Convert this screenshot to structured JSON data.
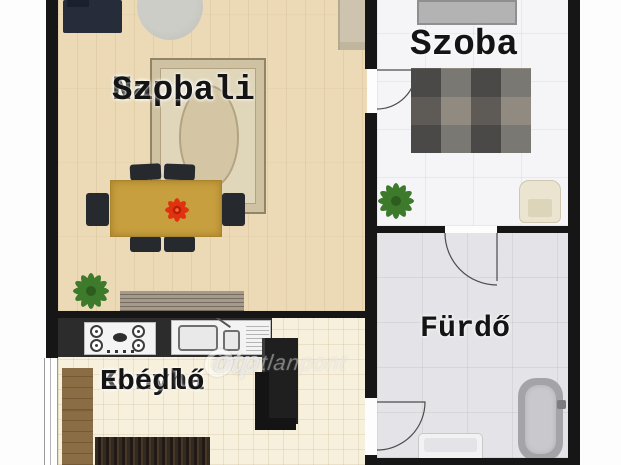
{
  "floorplan": {
    "rooms": {
      "living": {
        "label_line1": "Nappali",
        "label_line2": "Szoba"
      },
      "bedroom": {
        "label": "Szoba"
      },
      "bathroom": {
        "label": "Fürdő"
      },
      "kitchen": {
        "label_line1": "Konyha",
        "label_line2": "Ebédlő"
      }
    },
    "watermark": {
      "brand": "otp",
      "suffix": "ingatlanpont"
    },
    "colors": {
      "wall": "#161616",
      "wood_floor": "#ecdab6",
      "bedroom_tile": "#f5f5f8",
      "bathroom_tile": "#e4e4e8",
      "kitchen_tile": "#f7f0dd",
      "table": "#c79f3e",
      "flower_accent": "#e83010",
      "plant": "#3d7a2b"
    }
  }
}
